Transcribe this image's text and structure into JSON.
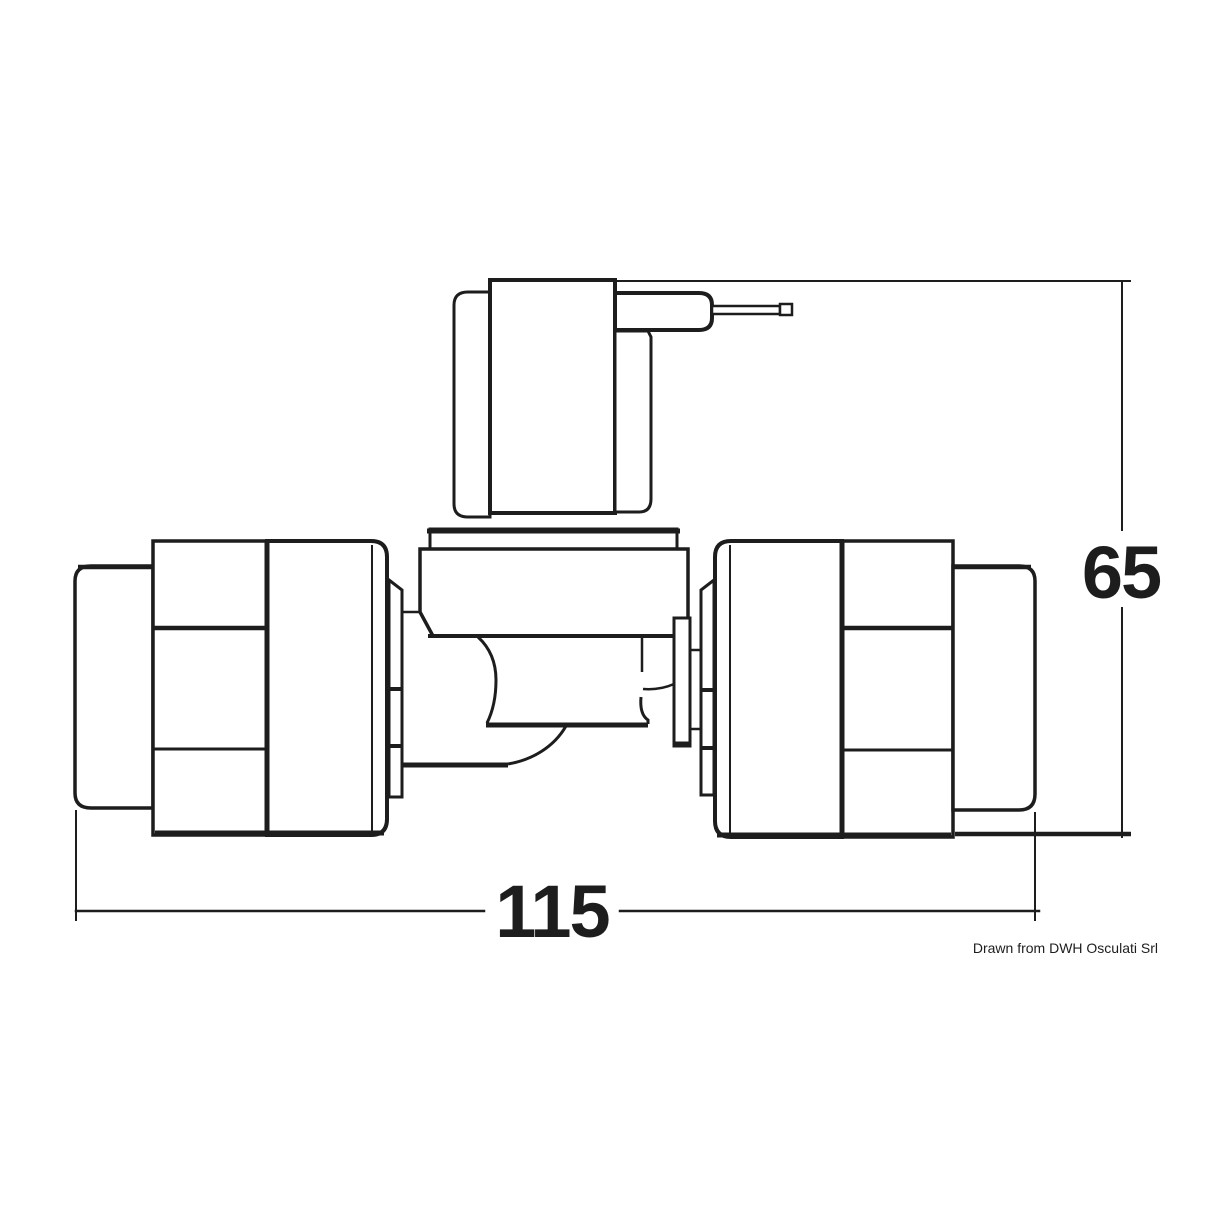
{
  "diagram": {
    "type": "technical-drawing",
    "subject": "solenoid valve with hose connectors, side elevation",
    "background_color": "#ffffff",
    "line_color": "#1d1d1d",
    "dimensions": {
      "vertical": {
        "value": "65",
        "orientation": "vertical",
        "position": "right"
      },
      "horizontal": {
        "value": "115",
        "orientation": "horizontal",
        "position": "bottom"
      }
    },
    "credit": "Drawn from DWH Osculati Srl"
  }
}
